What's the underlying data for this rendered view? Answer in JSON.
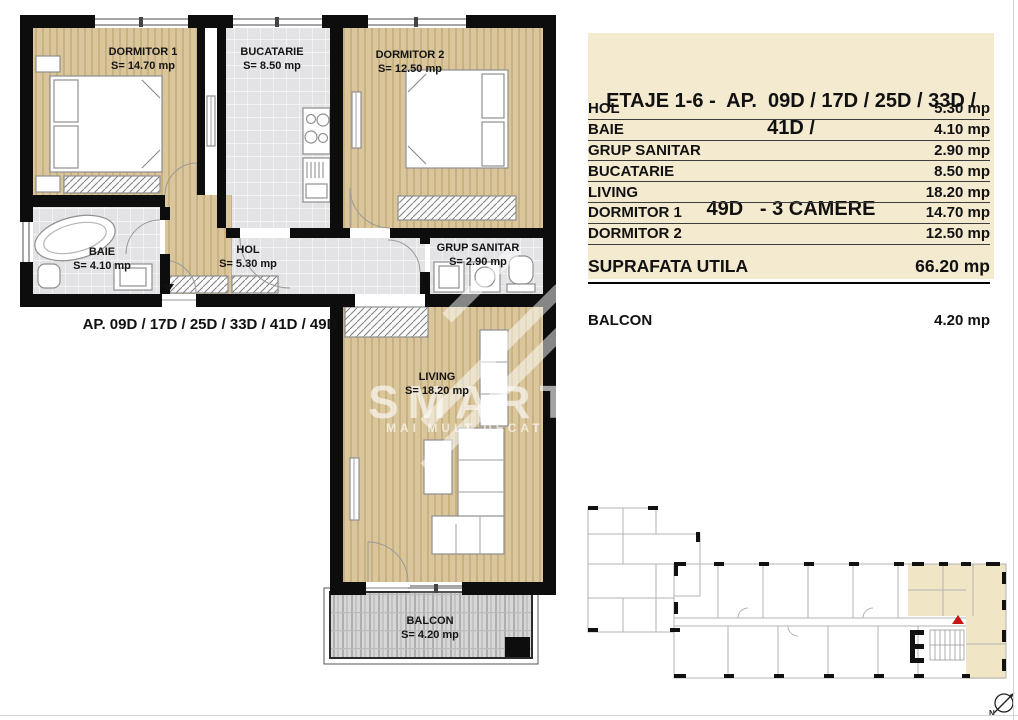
{
  "header": {
    "line1": "ETAJE 1-6 -  AP.  09D / 17D / 25D / 33D / 41D /",
    "line2": "49D   - 3 CAMERE",
    "background": "#f4ead0"
  },
  "area_table": {
    "rows": [
      {
        "label": "HOL",
        "value": "5.30 mp"
      },
      {
        "label": "BAIE",
        "value": "4.10 mp"
      },
      {
        "label": "GRUP SANITAR",
        "value": "2.90 mp"
      },
      {
        "label": "BUCATARIE",
        "value": "8.50 mp"
      },
      {
        "label": "LIVING",
        "value": "18.20 mp"
      },
      {
        "label": "DORMITOR 1",
        "value": "14.70 mp"
      },
      {
        "label": "DORMITOR 2",
        "value": "12.50 mp"
      }
    ]
  },
  "summary": {
    "label": "SUPRAFATA UTILA",
    "value": "66.20 mp"
  },
  "balcony": {
    "label": "BALCON",
    "value": "4.20 mp"
  },
  "floor_plan": {
    "caption": "AP.  09D / 17D / 25D / 33D / 41D / 49D",
    "rooms": [
      {
        "name": "DORMITOR 1",
        "area": "S= 14.70 mp"
      },
      {
        "name": "BUCATARIE",
        "area": "S= 8.50 mp"
      },
      {
        "name": "DORMITOR 2",
        "area": "S= 12.50 mp"
      },
      {
        "name": "BAIE",
        "area": "S= 4.10 mp"
      },
      {
        "name": "HOL",
        "area": "S= 5.30 mp"
      },
      {
        "name": "GRUP SANITAR",
        "area": "S= 2.90 mp"
      },
      {
        "name": "LIVING",
        "area": "S= 18.20 mp"
      },
      {
        "name": "BALCON",
        "area": "S= 4.20 mp"
      }
    ]
  },
  "watermark": {
    "brand": "SMART E",
    "tagline": "MAI MULT DECAT"
  },
  "compass": {
    "label": "N"
  },
  "colors": {
    "wall": "#0d0d0d",
    "wood": "#d9c69d",
    "tile": "#e3e3e6",
    "highlight": "#f0e6c6",
    "marker_red": "#c81616",
    "title_bg": "#f4ead0"
  }
}
